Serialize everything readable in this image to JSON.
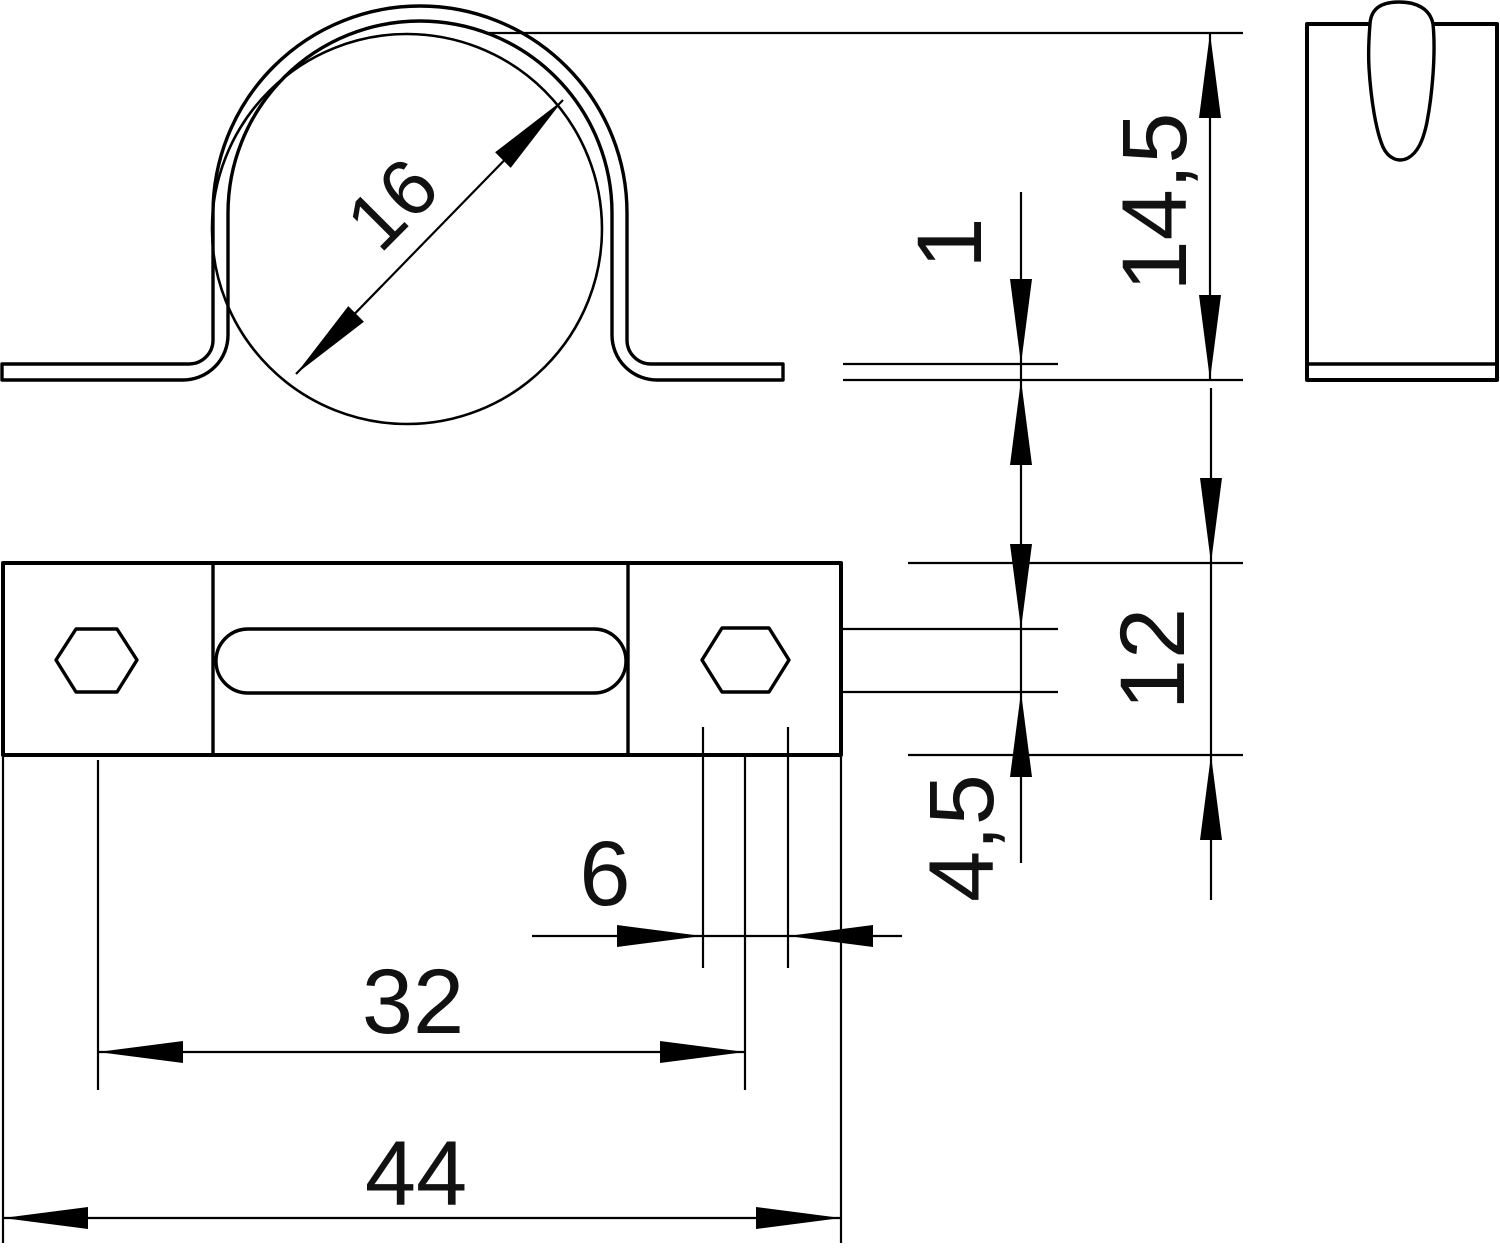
{
  "page": {
    "background": "#ffffff"
  },
  "drawing": {
    "line_color": "#000000",
    "text_color": "#111111",
    "dimensions": {
      "pipe_diameter": "16",
      "material_thickness": "1",
      "overall_height": "14,5",
      "clamp_width": "12",
      "hole_height": "4,5",
      "hole_width": "6",
      "hole_spacing": "32",
      "overall_length": "44"
    }
  }
}
